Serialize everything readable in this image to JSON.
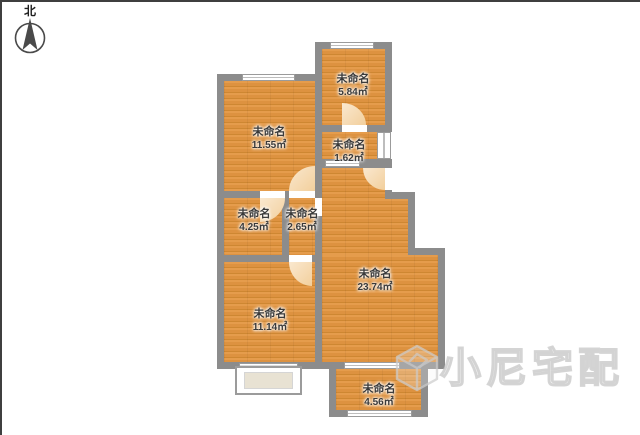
{
  "compass": {
    "label": "北"
  },
  "watermark": {
    "text": "小尼宅配"
  },
  "rooms": [
    {
      "name": "未命名",
      "area": "11.55㎡"
    },
    {
      "name": "未命名",
      "area": "5.84㎡"
    },
    {
      "name": "未命名",
      "area": "1.62㎡"
    },
    {
      "name": "未命名",
      "area": "4.25㎡"
    },
    {
      "name": "未命名",
      "area": "2.65㎡"
    },
    {
      "name": "未命名",
      "area": "23.74㎡"
    },
    {
      "name": "未命名",
      "area": "11.14㎡"
    },
    {
      "name": "未命名",
      "area": "4.56㎡"
    }
  ],
  "colors": {
    "floor": "#DE9440",
    "wall": "#8C8C8C",
    "door_arc": "#F5D8B0",
    "bay_fill": "#E8E2D3",
    "window_frame": "#9B9B9B"
  }
}
